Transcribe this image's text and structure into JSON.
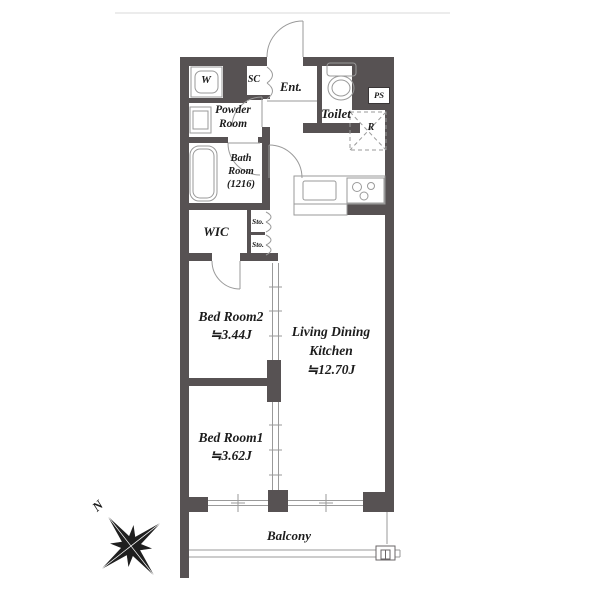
{
  "floorplan": {
    "rooms": {
      "washer": {
        "label": "W"
      },
      "shoe_closet": {
        "label": "SC"
      },
      "entrance": {
        "label": "Ent."
      },
      "toilet": {
        "label": "Toilet"
      },
      "pipe_space": {
        "label": "PS"
      },
      "refrigerator_space": {
        "label": "R"
      },
      "powder_room": {
        "line1": "Powder",
        "line2": "Room"
      },
      "bath_room": {
        "line1": "Bath",
        "line2": "Room",
        "line3": "(1216)"
      },
      "wic": {
        "label": "WIC"
      },
      "storage_upper": {
        "label": "Sto."
      },
      "storage_lower": {
        "label": "Sto."
      },
      "bedroom2": {
        "name": "Bed Room2",
        "area": "≒3.44J"
      },
      "ldk": {
        "line1": "Living Dining",
        "line2": "Kitchen",
        "area": "≒12.70J"
      },
      "bedroom1": {
        "name": "Bed Room1",
        "area": "≒3.62J"
      },
      "balcony": {
        "label": "Balcony"
      }
    },
    "compass": {
      "north_label": "N"
    },
    "colors": {
      "wall": "#575253",
      "fixture_line": "#9a9a9a",
      "text": "#1c1c1c",
      "background": "#ffffff",
      "compass": "#1f1f1f"
    }
  }
}
